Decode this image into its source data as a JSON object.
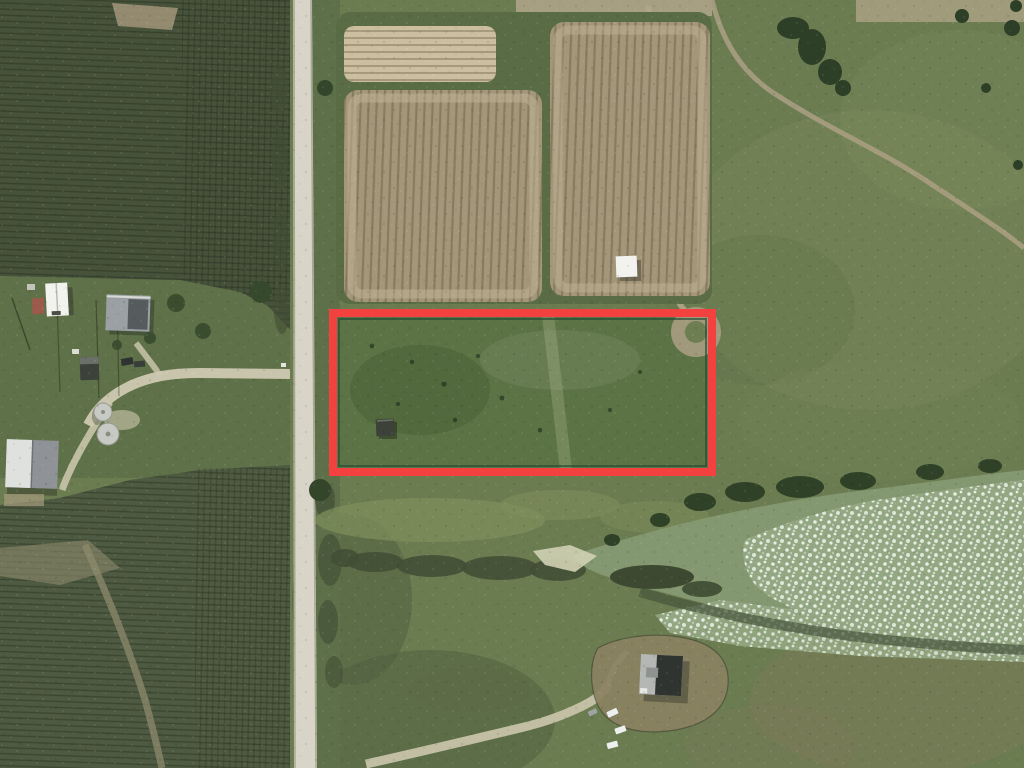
{
  "meta": {
    "view_type": "satellite-aerial-imagery",
    "scene": "rural farmland with outlined land parcel"
  },
  "palette": {
    "pasture": "#6b7c51",
    "pasture_light": "#7b8a5c",
    "crop_field": "#46523a",
    "crop_field_bottom": "#4e5a41",
    "farm_grass": "#5f7148",
    "road": "#d8d5c8",
    "verge": "#5d7049",
    "field_margin": "#5a6c45",
    "tan_field": "#a39679",
    "tan_field_light": "#cbbf9f",
    "parcel_grass": "#5c7345",
    "water": "#839770",
    "tree": "#2d3f26",
    "brush": "#424f35",
    "dirt_path": "#b2a689",
    "sand": "#d0d2b2",
    "lawn_brown": "#8a8162",
    "building_white": "#f2f3ef",
    "building_gray": "#b4b7b4",
    "roof_dark": "#2f3431",
    "shed_dark": "#3c423a",
    "silo_gray": "#c7c9c5",
    "barn_gray": "#8f9296",
    "shed_red": "#9b5a4a",
    "vehicle_white": "#eef0f0"
  },
  "overlay": {
    "parcel": {
      "x": 333,
      "y": 313,
      "width": 379,
      "height": 159,
      "stroke_color": "#f2413e",
      "stroke_width": 8,
      "inner_line_color": "#234a36"
    }
  },
  "features": {
    "names": [
      "gravel-road",
      "crop-fields",
      "tilled-fields",
      "pasture",
      "parcel-boundary",
      "farmstead",
      "grain-silos",
      "pond",
      "algae-mat",
      "house-lot",
      "driveways",
      "dirt-trails"
    ],
    "grain_silo_count": 2,
    "vehicles_near_south_house": 4,
    "sheds_in_parcel": 1
  }
}
